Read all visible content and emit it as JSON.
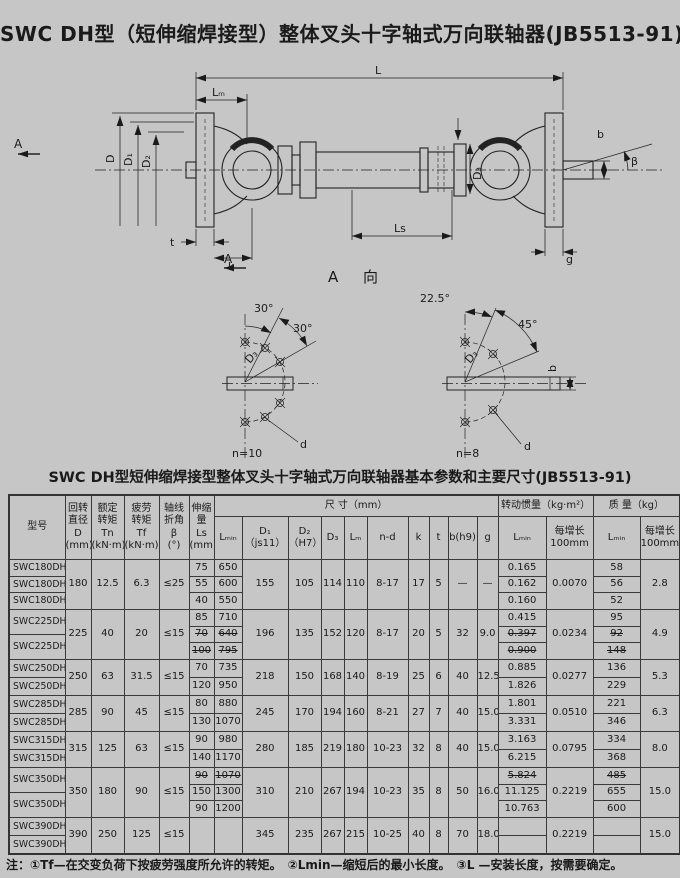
{
  "page": {
    "title": "SWC DH型（短伸缩焊接型）整体叉头十字轴式万向联轴器(JB5513-91)",
    "table_caption": "SWC DH型短伸缩焊接型整体叉头十字轴式万向联轴器基本参数和主要尺寸(JB5513-91)",
    "footnote": "注：①Tf—在交变负荷下按疲劳强度所允许的转矩。　②Lmin—缩短后的最小长度。　③L —安装长度，按需要确定。"
  },
  "drawing": {
    "labels": {
      "L": "L",
      "Lm": "Lₘ",
      "Ls": "Ls",
      "D": "D",
      "D1": "D₁",
      "D2": "D₂",
      "D3": "D₃",
      "t": "t",
      "k": "k",
      "g": "g",
      "b": "b",
      "beta": "β",
      "A": "A",
      "A_view": "A  向",
      "left_detail": {
        "a1": "30°",
        "a2": "30°",
        "D3": "D₃",
        "d": "d",
        "n": "n=10"
      },
      "right_detail": {
        "a1": "22.5°",
        "a2": "45°",
        "D3": "D₃",
        "d": "d",
        "n": "n=8",
        "b": "b"
      }
    }
  },
  "table": {
    "headers": {
      "model": "型号",
      "d": "回转\n直径\nD\n(mm)",
      "tn": "额定\n转矩\nTn\n(kN·m)",
      "tf": "疲劳\n转矩\nTf\n(kN·m)",
      "beta": "轴线\n折角\nβ\n(°)",
      "ls": "伸缩\n量\nLs\n(mm)",
      "size_band": "尺  寸（mm）",
      "inertia_band": "转动惯量（kg·m²）",
      "mass_band": "质  量（kg）",
      "lmin": "Lₘᵢₙ",
      "d1": "D₁\n（js11）",
      "d2": "D₂\n（H7）",
      "d3": "D₃",
      "lm": "Lₘ",
      "nd": "n-d",
      "k": "k",
      "t": "t",
      "b": "b(h9)",
      "g": "g",
      "j_lmin": "Lₘᵢₙ",
      "j_per": "每增长\n100mm",
      "m_lmin": "Lₘᵢₙ",
      "m_per": "每增长\n100mm"
    },
    "groups": [
      {
        "models": [
          "SWC180DH1",
          "SWC180DH2",
          "SWC180DH3"
        ],
        "d": "180",
        "tn": "12.5",
        "tf": "6.3",
        "beta": "≤25",
        "ls": [
          {
            "v": "75"
          },
          {
            "v": "55"
          },
          {
            "v": "40"
          }
        ],
        "lmin": [
          {
            "v": "650"
          },
          {
            "v": "600"
          },
          {
            "v": "550"
          }
        ],
        "j": [
          {
            "v": "0.165"
          },
          {
            "v": "0.162"
          },
          {
            "v": "0.160"
          }
        ],
        "mass": [
          {
            "v": "58"
          },
          {
            "v": "56"
          },
          {
            "v": "52"
          }
        ],
        "shared": {
          "d1": "155",
          "d2": "105",
          "d3": "114",
          "lm": "110",
          "nd": "8-17",
          "k": "17",
          "t": "5",
          "b": "—",
          "g": "—",
          "jper": "0.0070",
          "mper": "2.8"
        }
      },
      {
        "models": [
          "SWC225DH1",
          "SWC225DH2"
        ],
        "d": "225",
        "tn": "40",
        "tf": "20",
        "beta": "≤15",
        "ls": [
          {
            "v": "85"
          },
          {
            "v": "70",
            "s": true
          },
          {
            "v": "100",
            "s": true
          }
        ],
        "lmin": [
          {
            "v": "710"
          },
          {
            "v": "640",
            "s": true
          },
          {
            "v": "795",
            "s": true
          }
        ],
        "j": [
          {
            "v": "0.415"
          },
          {
            "v": "0.397",
            "s": true
          },
          {
            "v": "0.900",
            "s": true
          }
        ],
        "mass": [
          {
            "v": "95"
          },
          {
            "v": "92",
            "s": true
          },
          {
            "v": "148",
            "s": true
          }
        ],
        "shared": {
          "d1": "196",
          "d2": "135",
          "d3": "152",
          "lm": "120",
          "nd": "8-17",
          "k": "20",
          "t": "5",
          "b": "32",
          "g": "9.0",
          "jper": "0.0234",
          "mper": "4.9"
        }
      },
      {
        "models": [
          "SWC250DH1",
          "SWC250DH2"
        ],
        "d": "250",
        "tn": "63",
        "tf": "31.5",
        "beta": "≤15",
        "ls": [
          {
            "v": "70"
          },
          {
            "v": "120"
          }
        ],
        "lmin": [
          {
            "v": "735"
          },
          {
            "v": "950"
          }
        ],
        "j": [
          {
            "v": "0.885"
          },
          {
            "v": "1.826"
          }
        ],
        "mass": [
          {
            "v": "136"
          },
          {
            "v": "229"
          }
        ],
        "shared": {
          "d1": "218",
          "d2": "150",
          "d3": "168",
          "lm": "140",
          "nd": "8-19",
          "k": "25",
          "t": "6",
          "b": "40",
          "g": "12.5",
          "jper": "0.0277",
          "mper": "5.3"
        }
      },
      {
        "models": [
          "SWC285DH1",
          "SWC285DH2"
        ],
        "d": "285",
        "tn": "90",
        "tf": "45",
        "beta": "≤15",
        "ls": [
          {
            "v": "80"
          },
          {
            "v": "130"
          }
        ],
        "lmin": [
          {
            "v": "880"
          },
          {
            "v": "1070"
          }
        ],
        "j": [
          {
            "v": "1.801"
          },
          {
            "v": "3.331"
          }
        ],
        "mass": [
          {
            "v": "221"
          },
          {
            "v": "346"
          }
        ],
        "shared": {
          "d1": "245",
          "d2": "170",
          "d3": "194",
          "lm": "160",
          "nd": "8-21",
          "k": "27",
          "t": "7",
          "b": "40",
          "g": "15.0",
          "jper": "0.0510",
          "mper": "6.3"
        }
      },
      {
        "models": [
          "SWC315DH1",
          "SWC315DH2"
        ],
        "d": "315",
        "tn": "125",
        "tf": "63",
        "beta": "≤15",
        "ls": [
          {
            "v": "90"
          },
          {
            "v": "140"
          }
        ],
        "lmin": [
          {
            "v": "980"
          },
          {
            "v": "1170"
          }
        ],
        "j": [
          {
            "v": "3.163"
          },
          {
            "v": "6.215"
          }
        ],
        "mass": [
          {
            "v": "334"
          },
          {
            "v": "368"
          }
        ],
        "shared": {
          "d1": "280",
          "d2": "185",
          "d3": "219",
          "lm": "180",
          "nd": "10-23",
          "k": "32",
          "t": "8",
          "b": "40",
          "g": "15.0",
          "jper": "0.0795",
          "mper": "8.0"
        }
      },
      {
        "models": [
          "SWC350DH1",
          "SWC350DH2"
        ],
        "d": "350",
        "tn": "180",
        "tf": "90",
        "beta": "≤15",
        "ls": [
          {
            "v": "90",
            "s": true
          },
          {
            "v": "150"
          },
          {
            "v": "90"
          }
        ],
        "lmin": [
          {
            "v": "1070",
            "s": true
          },
          {
            "v": "1300"
          },
          {
            "v": "1200"
          }
        ],
        "j": [
          {
            "v": "5.824",
            "s": true
          },
          {
            "v": "11.125"
          },
          {
            "v": "10.763"
          }
        ],
        "mass": [
          {
            "v": "485",
            "s": true
          },
          {
            "v": "655"
          },
          {
            "v": "600"
          }
        ],
        "shared": {
          "d1": "310",
          "d2": "210",
          "d3": "267",
          "lm": "194",
          "nd": "10-23",
          "k": "35",
          "t": "8",
          "b": "50",
          "g": "16.0",
          "jper": "0.2219",
          "mper": "15.0"
        }
      },
      {
        "models": [
          "SWC390DH1",
          "SWC390DH2"
        ],
        "d": "390",
        "tn": "250",
        "tf": "125",
        "beta": "≤15",
        "ls": [
          {
            "v": ""
          }
        ],
        "lmin": [
          {
            "v": ""
          }
        ],
        "j": [
          {
            "v": ""
          },
          {
            "v": ""
          }
        ],
        "mass": [
          {
            "v": ""
          },
          {
            "v": ""
          }
        ],
        "shared": {
          "d1": "345",
          "d2": "235",
          "d3": "267",
          "lm": "215",
          "nd": "10-25",
          "k": "40",
          "t": "8",
          "b": "70",
          "g": "18.0",
          "jper": "0.2219",
          "mper": "15.0"
        }
      }
    ]
  }
}
